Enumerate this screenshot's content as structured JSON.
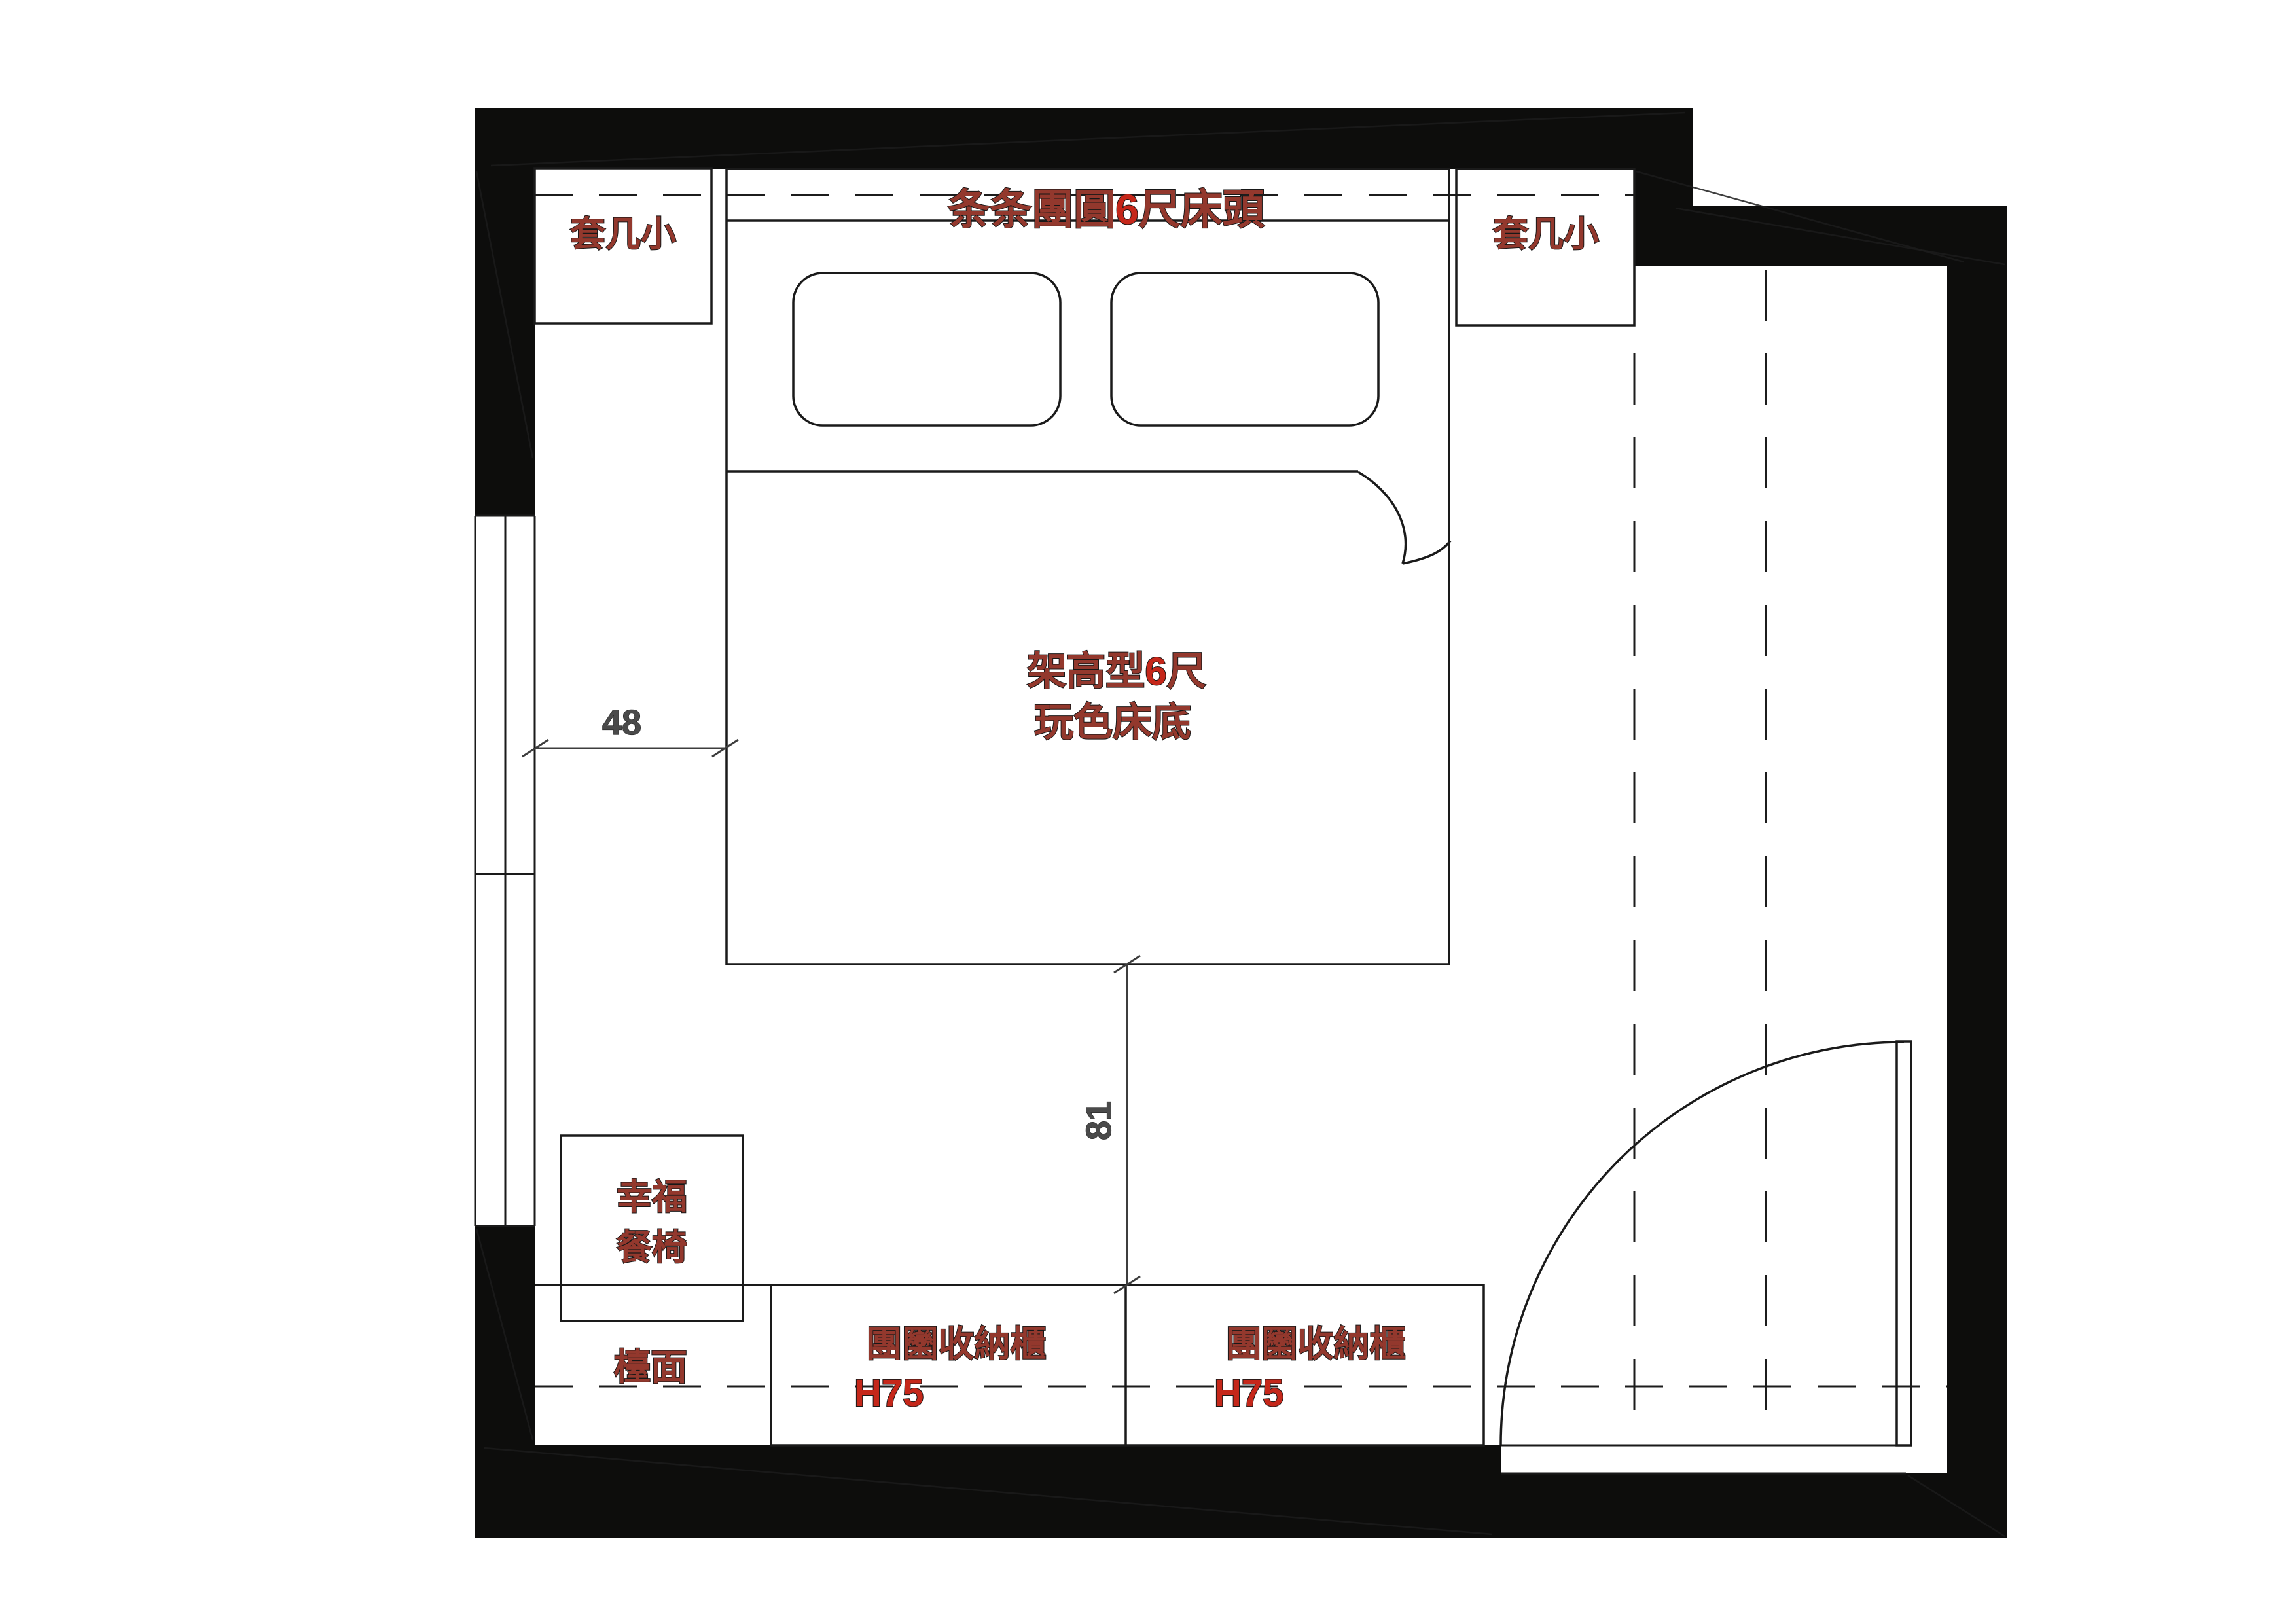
{
  "plan": {
    "headboard": {
      "prefix": "条条團圓",
      "accent": "6",
      "suffix": "尺床頭"
    },
    "bed": {
      "line1_prefix": "架高型",
      "line1_accent": "6",
      "line1_suffix": "尺",
      "line2": "玩色床底"
    },
    "nightstand_left": "套几小",
    "nightstand_right": "套几小",
    "chair": {
      "line1": "幸福",
      "line2": "餐椅"
    },
    "counter": "檯面",
    "cabinet_left": {
      "name": "團圞收納櫃",
      "height": "H75"
    },
    "cabinet_right": {
      "name": "團圞收納櫃",
      "height": "H75"
    },
    "dims": {
      "side_gap": "48",
      "front_gap": "81"
    }
  },
  "colors": {
    "wall": "#0d0d0c",
    "line": "#1a1a1a",
    "maroon": "#93382d",
    "accent": "#c5271a",
    "dim": "#4a4a4a",
    "bg": "#ffffff"
  }
}
